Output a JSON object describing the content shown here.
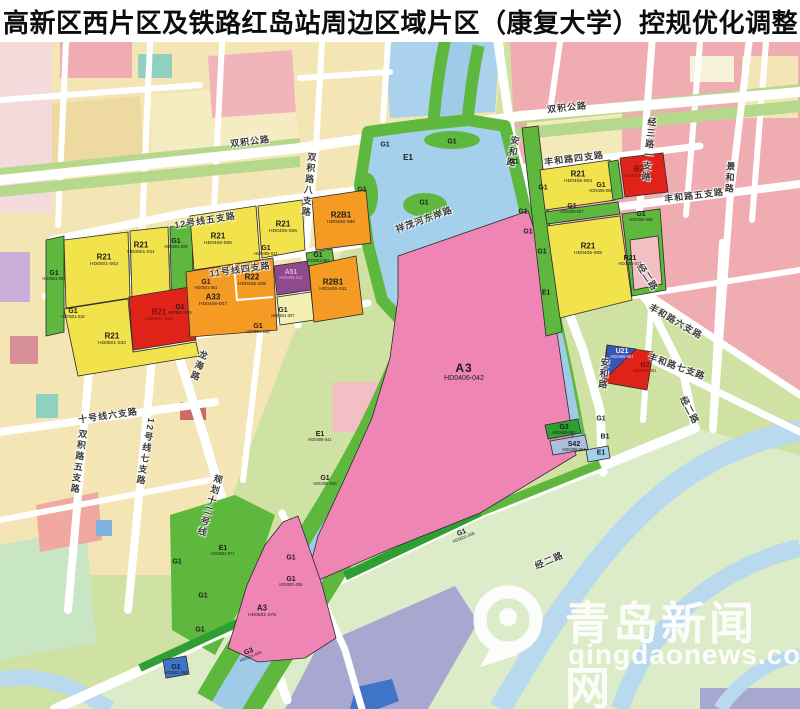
{
  "title": "高新区西片区及铁路红岛站周边区域片区（康复大学）控规优化调整",
  "watermark": {
    "name": "青岛新闻网",
    "url": "qingdaonews.com",
    "logo": "Q-logo"
  },
  "zoning_colors": {
    "residential_R21": "#f2e24b",
    "mixed_R2B_R22_A33": "#f59a23",
    "commercial_B": "#e02319",
    "campus_A3": "#ee85b5",
    "medical_A51": "#8e4a8c",
    "green_G1": "#5eb83e",
    "park_G3": "#2f9e33",
    "water_E1": "#a5d0ec",
    "utility_U": "#3f74c8",
    "transport_S42": "#aebedf"
  },
  "map": {
    "road_labels": [
      {
        "name": "双积公路",
        "x": 250,
        "y": 141,
        "rot": -7
      },
      {
        "name": "双积公路",
        "x": 567,
        "y": 107,
        "rot": -6
      },
      {
        "name": "安和路",
        "x": 513,
        "y": 152,
        "vertical": true,
        "rot": 10
      },
      {
        "name": "安和路",
        "x": 604,
        "y": 374,
        "vertical": true,
        "rot": 6
      },
      {
        "name": "丰和路四支路",
        "x": 574,
        "y": 158,
        "rot": -7
      },
      {
        "name": "丰和路五支路",
        "x": 694,
        "y": 195,
        "rot": -7
      },
      {
        "name": "丰和路六支路",
        "x": 676,
        "y": 321,
        "rot": 30
      },
      {
        "name": "丰和路七支路",
        "x": 677,
        "y": 366,
        "rot": 20
      },
      {
        "name": "经二路",
        "x": 648,
        "y": 277,
        "rot": 57
      },
      {
        "name": "经二路",
        "x": 690,
        "y": 410,
        "rot": 62
      },
      {
        "name": "经二路",
        "x": 549,
        "y": 560,
        "rot": -23
      },
      {
        "name": "经三路一支路",
        "x": 649,
        "y": 150,
        "vertical": true,
        "rot": 6
      },
      {
        "name": "景和路",
        "x": 730,
        "y": 178,
        "vertical": true,
        "rot": 4
      },
      {
        "name": "龙海路",
        "x": 199,
        "y": 366,
        "vertical": true,
        "rot": 20
      },
      {
        "name": "规划十二号线",
        "x": 210,
        "y": 506,
        "vertical": true,
        "rot": 17
      },
      {
        "name": "十号线六支路",
        "x": 108,
        "y": 415,
        "rot": -8
      },
      {
        "name": "双积路五支路",
        "x": 79,
        "y": 462,
        "vertical": true,
        "rot": 8
      },
      {
        "name": "12号线七支路",
        "x": 146,
        "y": 452,
        "vertical": true,
        "rot": 10
      },
      {
        "name": "12号线五支路",
        "x": 205,
        "y": 220,
        "rot": -9
      },
      {
        "name": "11号线四支路",
        "x": 240,
        "y": 269,
        "rot": -8
      },
      {
        "name": "祥茂河东岸路",
        "x": 424,
        "y": 219,
        "rot": -20
      },
      {
        "name": "双积路八支路",
        "x": 309,
        "y": 185,
        "vertical": true,
        "rot": 6
      }
    ],
    "parcel_labels": [
      {
        "type": "R21",
        "code": "HD0501-003",
        "x": 104,
        "y": 261
      },
      {
        "type": "R21",
        "code": "HD0501-011",
        "x": 141,
        "y": 249
      },
      {
        "type": "G1",
        "code": "HD0501-009",
        "x": 176,
        "y": 245,
        "size": "sm"
      },
      {
        "type": "G1",
        "code": "HD0501-097",
        "x": 54,
        "y": 277,
        "size": "sm"
      },
      {
        "type": "G1",
        "code": "HD0501-018",
        "x": 73,
        "y": 315,
        "size": "sm"
      },
      {
        "type": "R21",
        "code": "HD0501-033",
        "x": 112,
        "y": 340
      },
      {
        "type": "B21",
        "code": "HD0501-035",
        "x": 159,
        "y": 316,
        "tone": "dark"
      },
      {
        "type": "G1",
        "code": "HD0501-019",
        "x": 180,
        "y": 311,
        "size": "sm"
      },
      {
        "type": "G1",
        "code": "HD0501-046",
        "x": 258,
        "y": 330,
        "size": "sm"
      },
      {
        "type": "R21",
        "code": "HD0406-005",
        "x": 218,
        "y": 240
      },
      {
        "type": "R21",
        "code": "HD0406-006",
        "x": 283,
        "y": 228
      },
      {
        "type": "G1",
        "code": "HD0406-014",
        "x": 266,
        "y": 252,
        "size": "sm"
      },
      {
        "type": "R2B1",
        "code": "HD0406-080",
        "x": 341,
        "y": 219
      },
      {
        "type": "G1",
        "code": "HD0501-082",
        "x": 318,
        "y": 259,
        "size": "sm"
      },
      {
        "type": "R22",
        "code": "HD0406-008",
        "x": 252,
        "y": 281
      },
      {
        "type": "A51",
        "code": "HD0406-012",
        "x": 291,
        "y": 276,
        "tone": "purple",
        "size": "sm"
      },
      {
        "type": "A33",
        "code": "HD0406-007",
        "x": 213,
        "y": 301
      },
      {
        "type": "R2B1",
        "code": "HD0406-011",
        "x": 333,
        "y": 286
      },
      {
        "type": "G1",
        "code": "HD0501-007",
        "x": 283,
        "y": 314,
        "size": "sm"
      },
      {
        "type": "G1",
        "code": "HD0501-081",
        "x": 206,
        "y": 286,
        "size": "sm"
      },
      {
        "type": "E1",
        "x": 408,
        "y": 158
      },
      {
        "type": "G1",
        "x": 385,
        "y": 145,
        "size": "sm"
      },
      {
        "type": "G1",
        "x": 452,
        "y": 142,
        "size": "sm"
      },
      {
        "type": "G1",
        "x": 362,
        "y": 190,
        "size": "sm"
      },
      {
        "type": "G1",
        "x": 424,
        "y": 203,
        "size": "sm"
      },
      {
        "type": "G1",
        "x": 514,
        "y": 162,
        "size": "sm"
      },
      {
        "type": "G1",
        "x": 523,
        "y": 212,
        "size": "sm"
      },
      {
        "type": "G1",
        "x": 528,
        "y": 232,
        "size": "sm"
      },
      {
        "type": "G1",
        "x": 542,
        "y": 252,
        "size": "sm"
      },
      {
        "type": "E1",
        "x": 546,
        "y": 293,
        "size": "sm"
      },
      {
        "type": "A3",
        "code": "HD0406-042",
        "x": 464,
        "y": 372,
        "size": "lg"
      },
      {
        "type": "E1",
        "code": "HD0406-041",
        "x": 320,
        "y": 438,
        "size": "sm"
      },
      {
        "type": "G1",
        "code": "HD0406-040",
        "x": 325,
        "y": 482,
        "size": "sm"
      },
      {
        "type": "G3",
        "code": "HD0406-063",
        "x": 564,
        "y": 431,
        "size": "sm"
      },
      {
        "type": "S42",
        "code": "HD0406-064",
        "x": 574,
        "y": 448,
        "size": "sm"
      },
      {
        "type": "E1",
        "x": 601,
        "y": 453,
        "size": "sm"
      },
      {
        "type": "G1",
        "x": 601,
        "y": 419,
        "size": "sm"
      },
      {
        "type": "B1",
        "x": 605,
        "y": 437,
        "size": "sm"
      },
      {
        "type": "U21",
        "code": "HD0406-067",
        "x": 622,
        "y": 355,
        "tone": "light",
        "size": "sm"
      },
      {
        "type": "B2",
        "code": "HD0405-061",
        "x": 645,
        "y": 369,
        "tone": "dark",
        "size": "sm"
      },
      {
        "type": "R21",
        "code": "HD0405-004",
        "x": 578,
        "y": 178
      },
      {
        "type": "B2",
        "code": "HD0405-005",
        "x": 639,
        "y": 173,
        "tone": "dark"
      },
      {
        "type": "G1",
        "code": "HD0405-006",
        "x": 601,
        "y": 189,
        "size": "sm"
      },
      {
        "type": "G1",
        "code": "HD0405-007",
        "x": 572,
        "y": 210,
        "size": "sm"
      },
      {
        "type": "R21",
        "code": "HD0405-008",
        "x": 588,
        "y": 250
      },
      {
        "type": "G1",
        "code": "HD0405-009",
        "x": 641,
        "y": 218,
        "size": "sm"
      },
      {
        "type": "R21",
        "code": "HD0405-017",
        "x": 630,
        "y": 262,
        "size": "sm"
      },
      {
        "type": "G1",
        "x": 543,
        "y": 188,
        "size": "sm"
      },
      {
        "type": "G1",
        "code": "HD0501-058",
        "x": 463,
        "y": 536,
        "size": "sm",
        "rot": -22
      },
      {
        "type": "G1",
        "x": 177,
        "y": 562,
        "size": "sm"
      },
      {
        "type": "E1",
        "code": "HD0501-071",
        "x": 223,
        "y": 552,
        "size": "sm"
      },
      {
        "type": "G1",
        "x": 203,
        "y": 596,
        "size": "sm"
      },
      {
        "type": "G1",
        "x": 200,
        "y": 630,
        "size": "sm"
      },
      {
        "type": "A3",
        "code": "HD0501-078",
        "x": 262,
        "y": 612
      },
      {
        "type": "G1",
        "code": "HD0501-055",
        "x": 291,
        "y": 583,
        "size": "sm"
      },
      {
        "type": "G1",
        "x": 291,
        "y": 558,
        "size": "sm"
      },
      {
        "type": "G3",
        "code": "HD0501-059",
        "x": 250,
        "y": 655,
        "size": "sm",
        "rot": -22
      },
      {
        "type": "G1",
        "code": "HD0501-050",
        "x": 176,
        "y": 671,
        "size": "sm"
      }
    ]
  }
}
